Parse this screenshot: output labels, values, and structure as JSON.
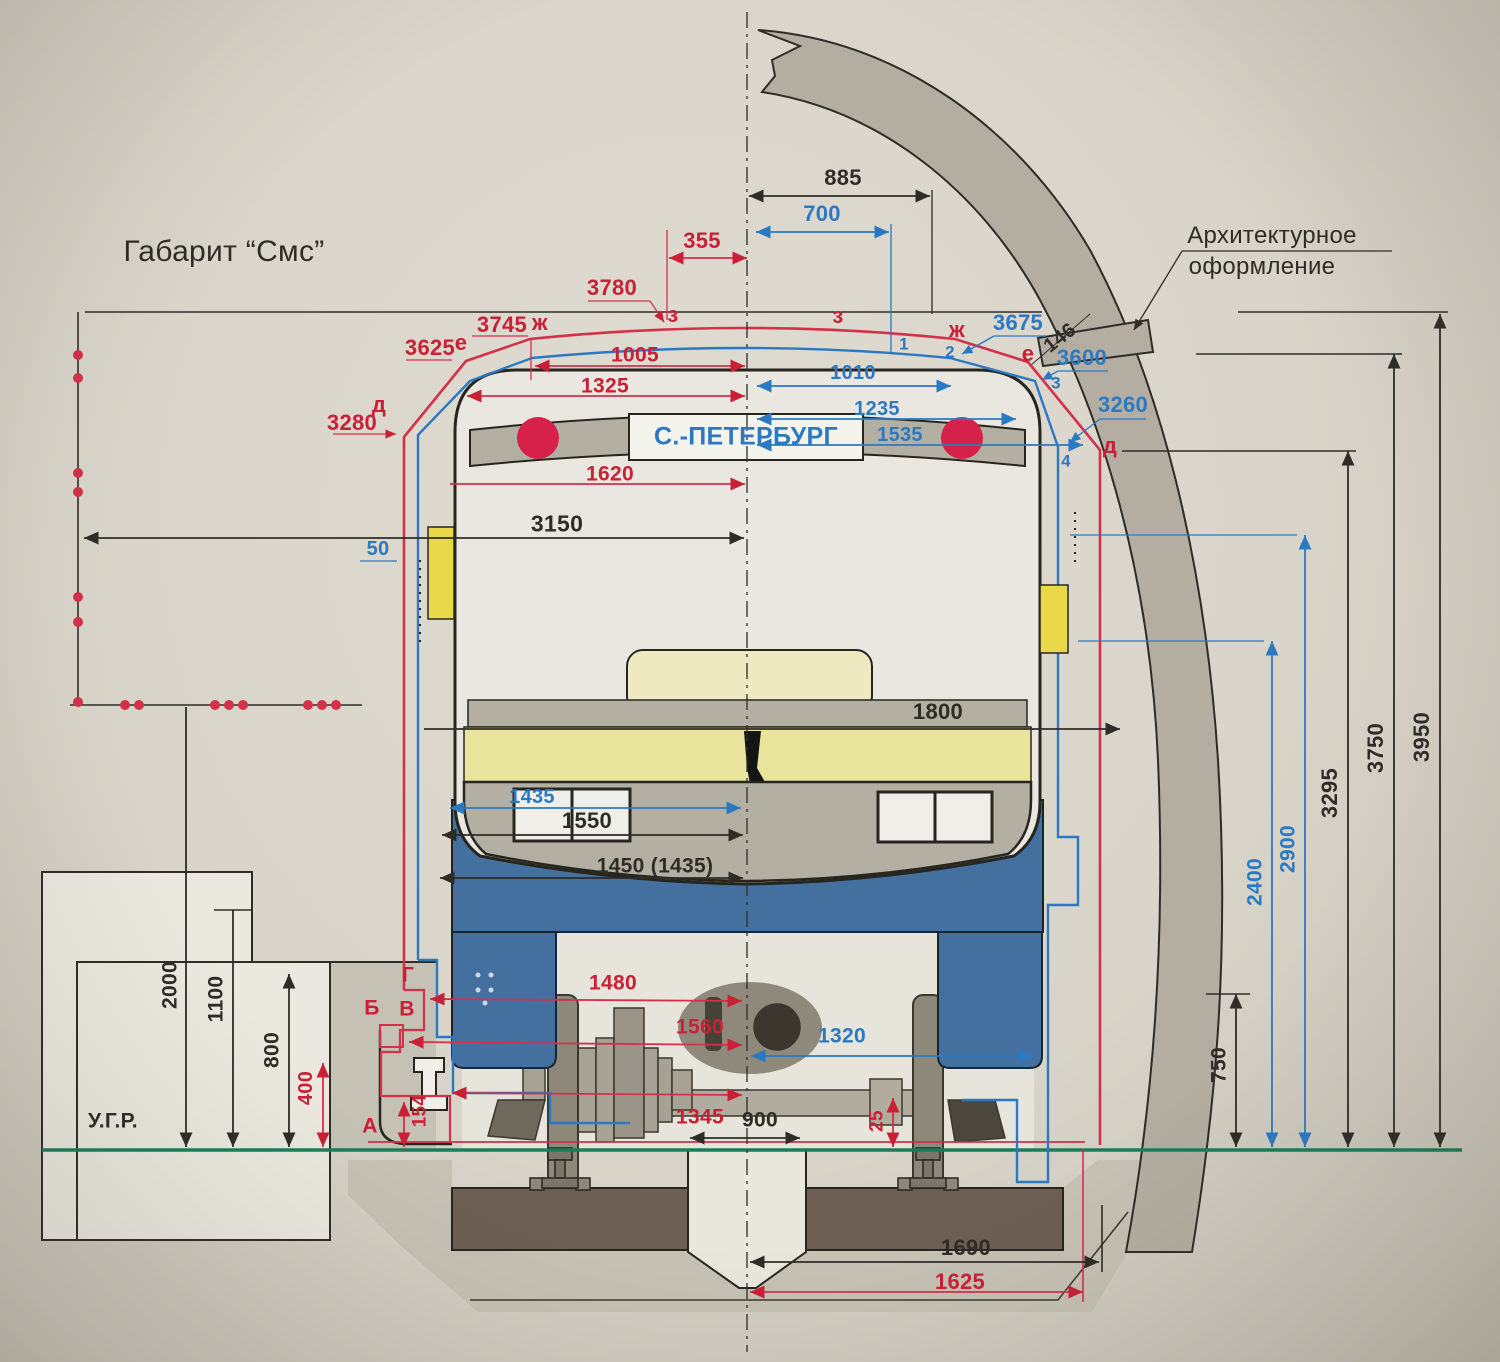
{
  "drawing": {
    "title": "Габарит “Смс”",
    "type": "metro-car-clearance-diagram",
    "route_sign": "С.-ПЕТЕРБУРГ",
    "rail_level_label": "У.Г.Р.",
    "architectural_callout": [
      "Архитектурное",
      "оформление"
    ]
  },
  "colors": {
    "ink": "#2e2c27",
    "red": "#c92036",
    "blue": "#2b79c2",
    "green": "#1f7a58",
    "paper": "#d8d4c9",
    "tunnel_band": "#b3aea1",
    "car_body": "#e9e7df",
    "car_mask": "#b4afa3",
    "skirt_blue": "#44709f",
    "stripe_yellow": "#e9e49c",
    "panel_cream": "#eee9c0",
    "sleeper_brown": "#6d5f53",
    "track_bed": "#c5c1b4"
  },
  "labels": [
    {
      "n": "drawing-title",
      "t": "Габарит “Смс”",
      "x": 224,
      "y": 252,
      "s": 30,
      "w": 400,
      "c": "ink"
    },
    {
      "n": "callout-architectural-1",
      "t": "Архитектурное",
      "x": 1272,
      "y": 236,
      "s": 24,
      "w": 400,
      "c": "ink"
    },
    {
      "n": "callout-architectural-2",
      "t": "оформление",
      "x": 1262,
      "y": 267,
      "s": 24,
      "w": 400,
      "c": "ink"
    },
    {
      "n": "train-route-sign",
      "t": "С.-ПЕТЕРБУРГ",
      "x": 746,
      "y": 437,
      "s": 25,
      "c": "blue"
    },
    {
      "n": "rail-head-level-label",
      "t": "У.Г.Р.",
      "x": 113,
      "y": 1121,
      "s": 21,
      "c": "ink"
    },
    {
      "n": "dim-885",
      "t": "885",
      "x": 843,
      "y": 178,
      "s": 22,
      "c": "ink"
    },
    {
      "n": "dim-3150",
      "t": "3150",
      "x": 557,
      "y": 524,
      "s": 23,
      "c": "ink"
    },
    {
      "n": "dim-1800",
      "t": "1800",
      "x": 938,
      "y": 712,
      "s": 22,
      "c": "ink"
    },
    {
      "n": "dim-1550",
      "t": "1550",
      "x": 587,
      "y": 821,
      "s": 22,
      "c": "ink"
    },
    {
      "n": "dim-1450-1435",
      "t": "1450 (1435)",
      "x": 655,
      "y": 866,
      "s": 21,
      "c": "ink"
    },
    {
      "n": "dim-900",
      "t": "900",
      "x": 760,
      "y": 1120,
      "s": 21,
      "c": "ink"
    },
    {
      "n": "dim-1690",
      "t": "1690",
      "x": 966,
      "y": 1248,
      "s": 22,
      "c": "ink"
    },
    {
      "n": "dim-2000",
      "t": "2000",
      "x": 170,
      "y": 985,
      "s": 21,
      "r": -90,
      "c": "ink"
    },
    {
      "n": "dim-1100",
      "t": "1100",
      "x": 216,
      "y": 999,
      "s": 21,
      "r": -90,
      "c": "ink"
    },
    {
      "n": "dim-800",
      "t": "800",
      "x": 272,
      "y": 1050,
      "s": 21,
      "r": -90,
      "c": "ink"
    },
    {
      "n": "dim-750",
      "t": "750",
      "x": 1219,
      "y": 1065,
      "s": 21,
      "r": -90,
      "c": "ink"
    },
    {
      "n": "dim-3295",
      "t": "3295",
      "x": 1330,
      "y": 793,
      "s": 22,
      "r": -90,
      "c": "ink"
    },
    {
      "n": "dim-3750",
      "t": "3750",
      "x": 1376,
      "y": 748,
      "s": 22,
      "r": -90,
      "c": "ink"
    },
    {
      "n": "dim-3950",
      "t": "3950",
      "x": 1422,
      "y": 737,
      "s": 22,
      "r": -90,
      "c": "ink"
    },
    {
      "n": "dim-146",
      "t": "146",
      "x": 1060,
      "y": 338,
      "s": 20,
      "r": -38,
      "c": "ink"
    },
    {
      "n": "dim-355",
      "t": "355",
      "x": 702,
      "y": 241,
      "s": 22,
      "c": "red"
    },
    {
      "n": "dim-3780",
      "t": "3780",
      "x": 612,
      "y": 288,
      "s": 22,
      "c": "red"
    },
    {
      "n": "dim-3745",
      "t": "3745",
      "x": 502,
      "y": 325,
      "s": 22,
      "c": "red"
    },
    {
      "n": "dim-3625",
      "t": "3625",
      "x": 430,
      "y": 348,
      "s": 22,
      "c": "red"
    },
    {
      "n": "dim-3280",
      "t": "3280",
      "x": 352,
      "y": 423,
      "s": 22,
      "c": "red"
    },
    {
      "n": "dim-1005",
      "t": "1005",
      "x": 635,
      "y": 355,
      "s": 21,
      "c": "red"
    },
    {
      "n": "dim-1325",
      "t": "1325",
      "x": 605,
      "y": 386,
      "s": 21,
      "c": "red"
    },
    {
      "n": "dim-1620",
      "t": "1620",
      "x": 610,
      "y": 474,
      "s": 21,
      "c": "red"
    },
    {
      "n": "dim-1480",
      "t": "1480",
      "x": 613,
      "y": 983,
      "s": 21,
      "c": "red"
    },
    {
      "n": "dim-1560",
      "t": "1560",
      "x": 700,
      "y": 1027,
      "s": 21,
      "c": "red"
    },
    {
      "n": "dim-1345",
      "t": "1345",
      "x": 700,
      "y": 1117,
      "s": 21,
      "c": "red"
    },
    {
      "n": "dim-1625",
      "t": "1625",
      "x": 960,
      "y": 1282,
      "s": 22,
      "c": "red"
    },
    {
      "n": "dim-400",
      "t": "400",
      "x": 306,
      "y": 1088,
      "s": 20,
      "r": -90,
      "c": "red"
    },
    {
      "n": "dim-154",
      "t": "154",
      "x": 420,
      "y": 1111,
      "s": 19,
      "r": -90,
      "c": "red"
    },
    {
      "n": "dim-25",
      "t": "25",
      "x": 877,
      "y": 1121,
      "s": 19,
      "r": -90,
      "c": "red"
    },
    {
      "n": "point-d-left",
      "t": "д",
      "x": 379,
      "y": 405,
      "s": 22,
      "c": "red"
    },
    {
      "n": "point-e-left",
      "t": "е",
      "x": 461,
      "y": 343,
      "s": 22,
      "c": "red"
    },
    {
      "n": "point-zh-left",
      "t": "ж",
      "x": 540,
      "y": 323,
      "s": 22,
      "c": "red"
    },
    {
      "n": "point-z-left",
      "t": "з",
      "x": 673,
      "y": 315,
      "s": 22,
      "c": "red"
    },
    {
      "n": "point-z-right",
      "t": "з",
      "x": 838,
      "y": 316,
      "s": 22,
      "c": "red"
    },
    {
      "n": "point-zh-right",
      "t": "ж",
      "x": 957,
      "y": 330,
      "s": 22,
      "c": "red"
    },
    {
      "n": "point-e-right",
      "t": "е",
      "x": 1028,
      "y": 354,
      "s": 22,
      "c": "red"
    },
    {
      "n": "point-d-right",
      "t": "д",
      "x": 1110,
      "y": 446,
      "s": 22,
      "c": "red"
    },
    {
      "n": "point-g",
      "t": "Г",
      "x": 408,
      "y": 975,
      "s": 21,
      "c": "red"
    },
    {
      "n": "point-b",
      "t": "Б",
      "x": 372,
      "y": 1008,
      "s": 21,
      "c": "red"
    },
    {
      "n": "point-v",
      "t": "В",
      "x": 407,
      "y": 1009,
      "s": 21,
      "c": "red"
    },
    {
      "n": "point-a",
      "t": "А",
      "x": 370,
      "y": 1126,
      "s": 21,
      "c": "red"
    },
    {
      "n": "dim-700",
      "t": "700",
      "x": 822,
      "y": 214,
      "s": 22,
      "c": "blue"
    },
    {
      "n": "dim-3675",
      "t": "3675",
      "x": 1018,
      "y": 323,
      "s": 22,
      "c": "blue"
    },
    {
      "n": "dim-3600",
      "t": "3600",
      "x": 1082,
      "y": 358,
      "s": 22,
      "c": "blue"
    },
    {
      "n": "dim-3260",
      "t": "3260",
      "x": 1123,
      "y": 405,
      "s": 22,
      "c": "blue"
    },
    {
      "n": "dim-1010",
      "t": "1010",
      "x": 853,
      "y": 373,
      "s": 20,
      "c": "blue"
    },
    {
      "n": "dim-1235",
      "t": "1235",
      "x": 877,
      "y": 409,
      "s": 20,
      "c": "blue"
    },
    {
      "n": "dim-1535",
      "t": "1535",
      "x": 900,
      "y": 435,
      "s": 20,
      "c": "blue"
    },
    {
      "n": "dim-1435",
      "t": "1435",
      "x": 532,
      "y": 797,
      "s": 20,
      "c": "blue"
    },
    {
      "n": "dim-50",
      "t": "50",
      "x": 378,
      "y": 549,
      "s": 20,
      "c": "blue"
    },
    {
      "n": "dim-1320",
      "t": "1320",
      "x": 842,
      "y": 1036,
      "s": 21,
      "c": "blue"
    },
    {
      "n": "dim-2400",
      "t": "2400",
      "x": 1255,
      "y": 882,
      "s": 21,
      "r": -90,
      "c": "blue"
    },
    {
      "n": "dim-2900",
      "t": "2900",
      "x": 1288,
      "y": 849,
      "s": 21,
      "r": -90,
      "c": "blue"
    },
    {
      "n": "point-1",
      "t": "1",
      "x": 904,
      "y": 344,
      "s": 17,
      "c": "blue"
    },
    {
      "n": "point-2",
      "t": "2",
      "x": 950,
      "y": 352,
      "s": 17,
      "c": "blue"
    },
    {
      "n": "point-3",
      "t": "3",
      "x": 1056,
      "y": 383,
      "s": 17,
      "c": "blue"
    },
    {
      "n": "point-4",
      "t": "4",
      "x": 1066,
      "y": 461,
      "s": 17,
      "c": "blue"
    }
  ]
}
